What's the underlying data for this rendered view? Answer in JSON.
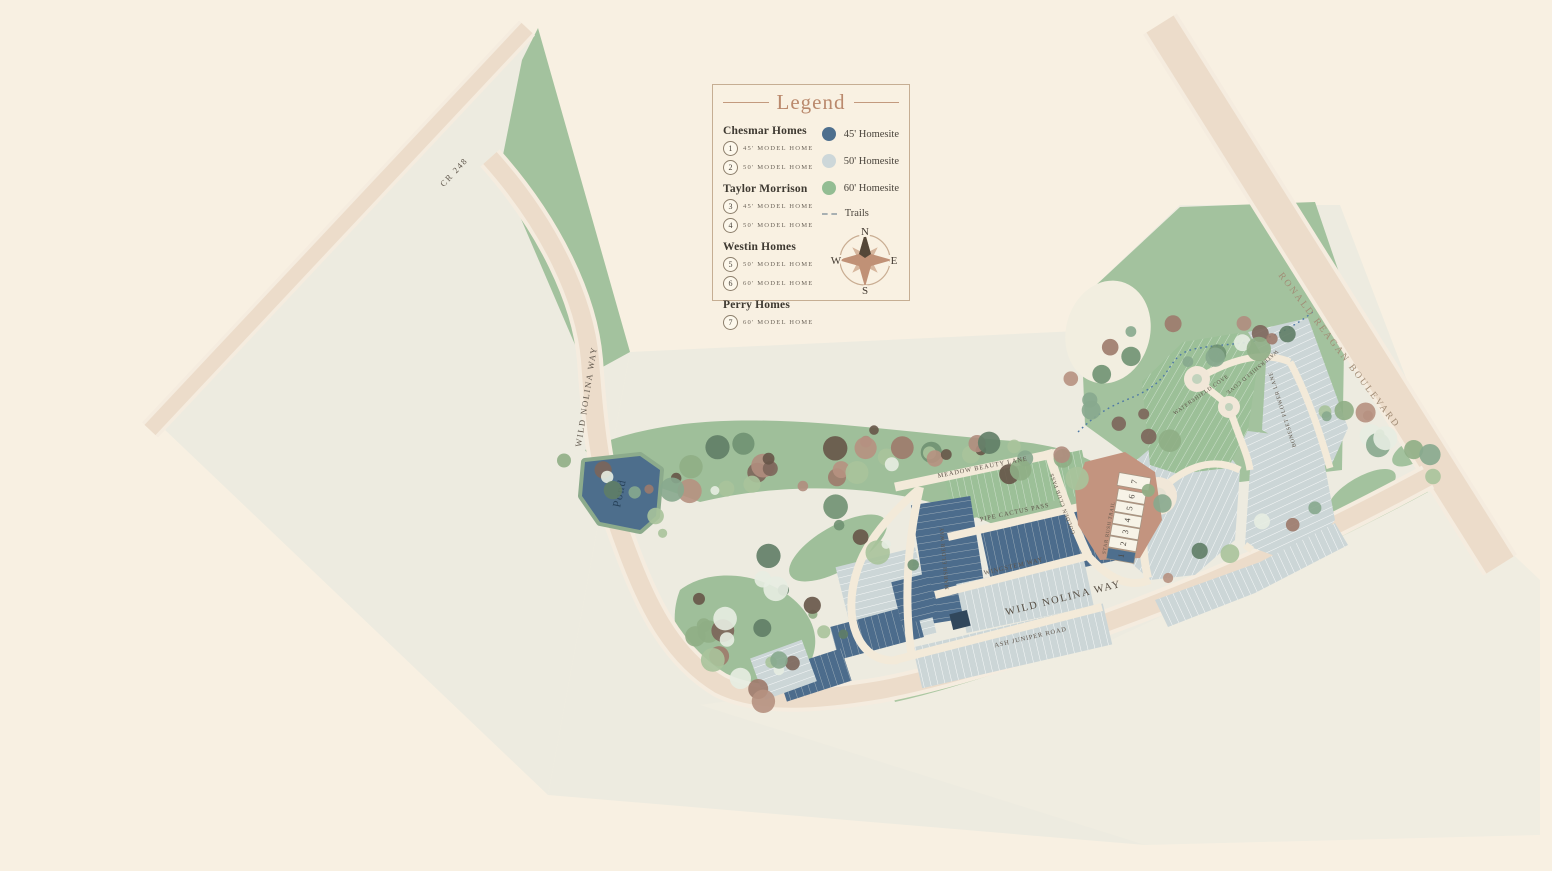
{
  "legend": {
    "title": "Legend",
    "builders": [
      {
        "name": "Chesmar Homes",
        "models": [
          {
            "num": "1",
            "label": "45' MODEL HOME"
          },
          {
            "num": "2",
            "label": "50' MODEL HOME"
          }
        ]
      },
      {
        "name": "Taylor Morrison",
        "models": [
          {
            "num": "3",
            "label": "45' MODEL HOME"
          },
          {
            "num": "4",
            "label": "50' MODEL HOME"
          }
        ]
      },
      {
        "name": "Westin Homes",
        "models": [
          {
            "num": "5",
            "label": "50' MODEL HOME"
          },
          {
            "num": "6",
            "label": "60' MODEL HOME"
          }
        ]
      },
      {
        "name": "Perry Homes",
        "models": [
          {
            "num": "7",
            "label": "60' MODEL HOME"
          }
        ]
      }
    ],
    "swatches": [
      {
        "label": "45' Homesite",
        "color": "#4e6f8e"
      },
      {
        "label": "50' Homesite",
        "color": "#cdd7d9"
      },
      {
        "label": "60' Homesite",
        "color": "#93bd93"
      }
    ],
    "trails_label": "Trails",
    "compass": {
      "n": "N",
      "e": "E",
      "s": "S",
      "w": "W"
    }
  },
  "map": {
    "roads": {
      "cr248": "CR 248",
      "wild_nolina_west": "WILD NOLINA WAY",
      "wild_nolina_south": "WILD NOLINA WAY",
      "ronald_reagan": "RONALD REAGAN BOULEVARD"
    },
    "streets": {
      "meadow_beauty": "MEADOW BEAUTY LANE",
      "pipe_cactus": "PIPE CACTUS PASS",
      "wingstem": "WINGSTEM WAY",
      "ash_juniper": "ASH JUNIPER ROAD",
      "golden_club": "GOLDEN CLUB PASS",
      "marsh_elder": "MARSH ELDER WAY",
      "star_rush": "STAR RUSH TRAIL",
      "watershield_1": "WATERSHIELD COVE",
      "watershield_2": "WATERSHIELD COVE",
      "boneset": "BONESET FLOWER LANE"
    },
    "pond_label": "Pond",
    "model_lot_numbers": [
      "1",
      "2",
      "3",
      "4",
      "5",
      "6",
      "7"
    ]
  },
  "colors": {
    "background": "#f8f0e2",
    "parcel": "#edebe0",
    "greenspace": "#a3c29e",
    "road": "#ecdcca",
    "homesite_45": "#4e6f8e",
    "homesite_50": "#cdd7d9",
    "homesite_60": "#93bd93",
    "pond": "#4d6e8c",
    "amenity": "#c3947f",
    "trail": "#4f79a5",
    "accent": "#ba896c"
  }
}
